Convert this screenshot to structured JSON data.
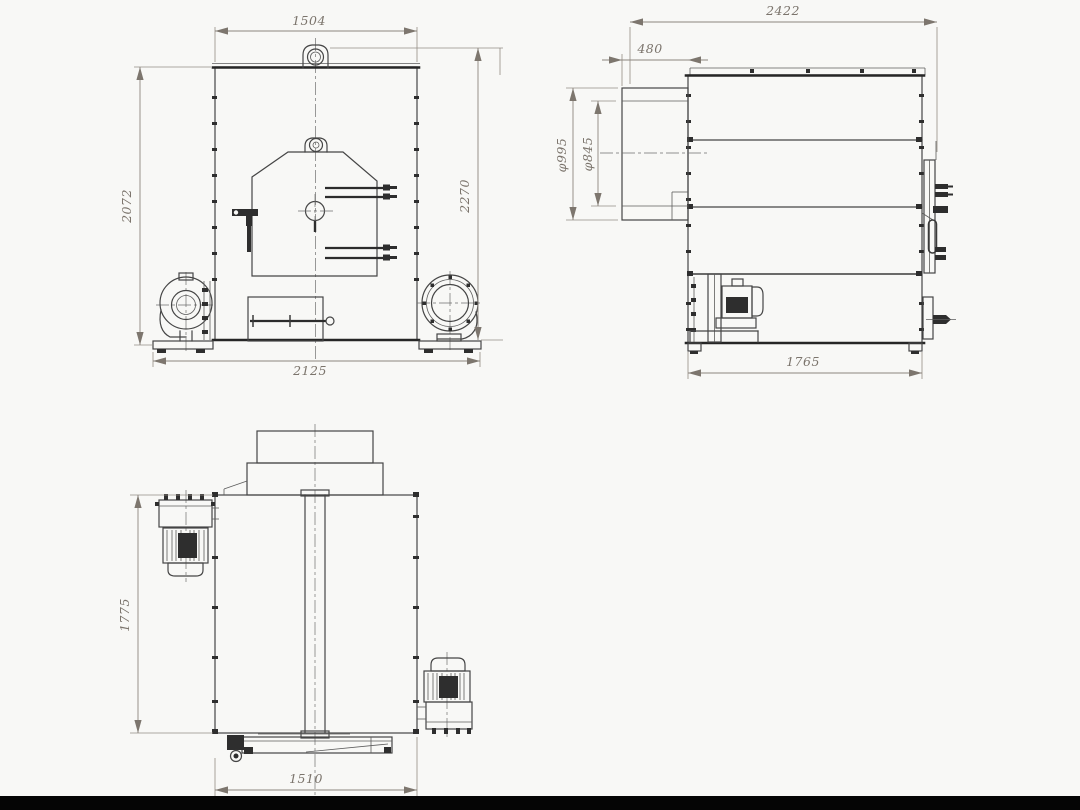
{
  "page": {
    "background": "#f8f8f6",
    "footer_bar_color": "#050505",
    "line_color": "#454545",
    "dim_color": "#7b746c"
  },
  "drawing": {
    "views": {
      "front": {
        "dim_top_width": "1504",
        "dim_left_height": "2072",
        "dim_right_height": "2270",
        "dim_bottom_width": "2125"
      },
      "side": {
        "dim_top_width": "2422",
        "dim_flue_offset": "480",
        "dim_flue_outer_diameter": "φ995",
        "dim_flue_inner_diameter": "φ845",
        "dim_bottom_width": "1765"
      },
      "rear": {
        "dim_left_height": "1775",
        "dim_bottom_width": "1510"
      }
    }
  }
}
